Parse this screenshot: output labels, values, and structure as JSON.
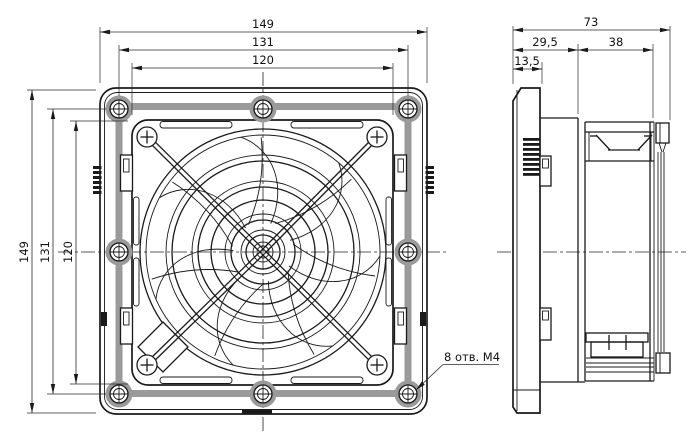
{
  "drawing": {
    "colors": {
      "line": "#1a1a1a",
      "gasket_gray": "#9a9a9a",
      "background": "#ffffff"
    },
    "front_view": {
      "width_dims": {
        "outer": "149",
        "mount": "131",
        "inner": "120"
      },
      "height_dims": {
        "outer": "149",
        "mount": "131",
        "inner": "120"
      },
      "note_holes": "8 отв. M4"
    },
    "side_view": {
      "depth_total": "73",
      "depth_front": "29,5",
      "depth_fan": "38",
      "depth_bezel": "13,5"
    }
  }
}
